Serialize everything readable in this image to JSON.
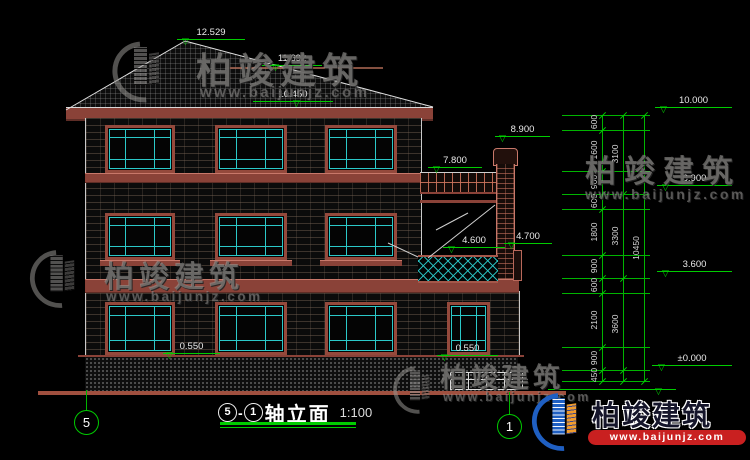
{
  "title": {
    "axis_start": "5",
    "sep": "-",
    "axis_end": "1",
    "name": "轴立面",
    "scale": "1:100"
  },
  "elevations": {
    "roof_peak": "12.529",
    "roof_ridge": "11.692",
    "eave": "10.450",
    "chimney_top": "8.900",
    "porch_roof": "7.800",
    "balcony_rail": "4.600",
    "balcony_beam": "4.700",
    "sill_left": "0.550",
    "sill_right": "0.550",
    "level_top": "10.000",
    "level_3": "6.900",
    "level_2": "3.600",
    "level_ground": "±0.000"
  },
  "dimensions": {
    "inner": [
      "600",
      "1600",
      "900",
      "600",
      "1800",
      "900",
      "600",
      "2100",
      "900",
      "450"
    ],
    "middle": [
      "3100",
      "3300",
      "3600"
    ],
    "outer": [
      "10450"
    ]
  },
  "axis_bubbles": {
    "left": "5",
    "right": "1"
  },
  "watermark": {
    "cn": "柏竣建筑",
    "url": "www.baijunjz.com"
  },
  "logo": {
    "cn": "柏竣建筑",
    "url": "www.baijunjz.com"
  },
  "colors": {
    "dim_green": "#00cc00",
    "line_red": "#8a4238",
    "window_teal": "#2bc8c8"
  }
}
